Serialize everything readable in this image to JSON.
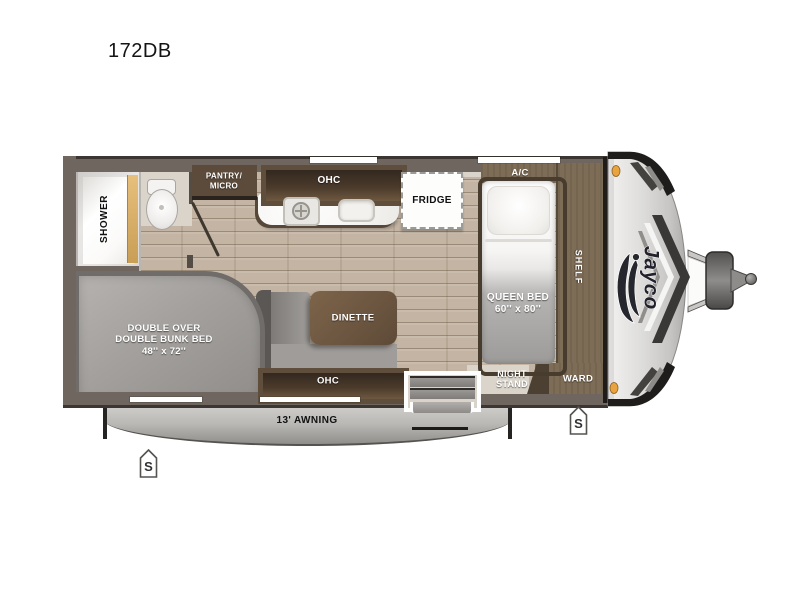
{
  "model": "172DB",
  "interior": {
    "shower": "SHOWER",
    "pantry": {
      "line1": "PANTRY/",
      "line2": "MICRO"
    },
    "kitchen_overhead_cabinet": "OHC",
    "fridge": "FRIDGE",
    "air_conditioner": "A/C",
    "queen_bed": {
      "line1": "QUEEN BED",
      "line2": "60'' x 80''"
    },
    "shelf": "SHELF",
    "night_stand": {
      "line1": "NIGHT",
      "line2": "STAND"
    },
    "wardrobe": "WARD",
    "dinette": "DINETTE",
    "dinette_overhead_cabinet": "OHC",
    "bunk_bed": {
      "line1": "DOUBLE OVER",
      "line2": "DOUBLE BUNK BED",
      "line3": "48'' x 72''"
    }
  },
  "exterior": {
    "awning": "13' AWNING",
    "brand_logo": "Jayco",
    "stabilizer_front": "S",
    "stabilizer_rear": "S"
  },
  "colors": {
    "wall": "#6f675f",
    "floor_wood": "#c3b4a3",
    "cabinet_wood_dark": "#5f4e3c",
    "platform_wood": "#7e6d56",
    "interior_beige": "#dad4ca",
    "countertop": "#f6f5f2",
    "awning_gray": "#b7b5b2",
    "marker_light_amber": "#e9a43f",
    "mattress_gray": "#9d9b99"
  }
}
